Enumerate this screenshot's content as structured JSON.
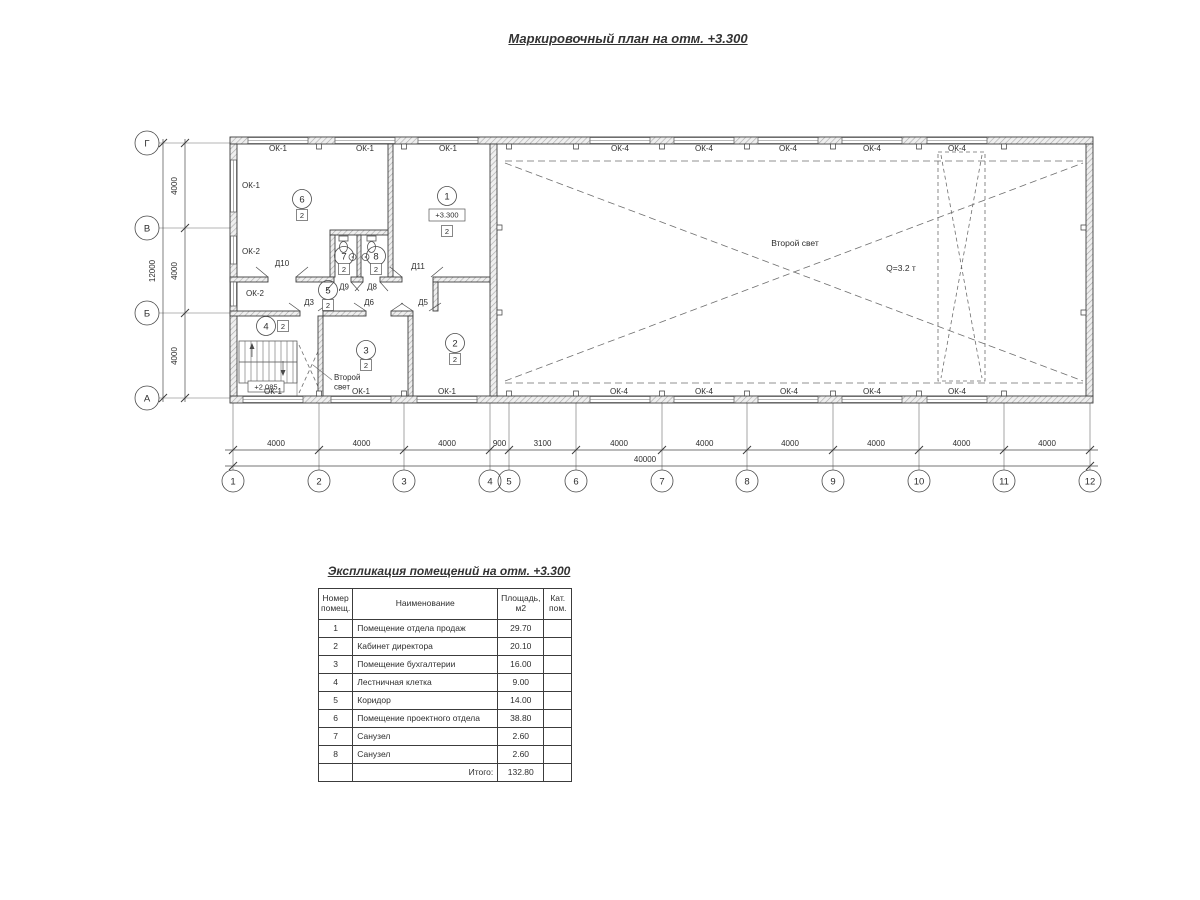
{
  "titles": {
    "plan": "Маркировочный план на отм. +3.300",
    "table": "Экспликация помещений на отм. +3.300"
  },
  "plan": {
    "axis_rows": [
      "Г",
      "В",
      "Б",
      "А"
    ],
    "axis_cols": [
      "1",
      "2",
      "3",
      "4",
      "5",
      "6",
      "7",
      "8",
      "9",
      "10",
      "11",
      "12"
    ],
    "dims_h": [
      "4000",
      "4000",
      "4000",
      "900",
      "3100",
      "4000",
      "4000",
      "4000",
      "4000",
      "4000",
      "4000"
    ],
    "dims_h_total": "40000",
    "dims_v": [
      "4000",
      "4000",
      "4000"
    ],
    "dims_v_total": "12000",
    "windows": {
      "ok1": "ОК-1",
      "ok2": "ОК-2",
      "ok4": "ОК-4"
    },
    "doors": {
      "d3": "Д3",
      "d5": "Д5",
      "d6": "Д6",
      "d8": "Д8",
      "d9": "Д9",
      "d10": "Д10",
      "d11": "Д11"
    },
    "rooms": [
      "1",
      "2",
      "3",
      "4",
      "5",
      "6",
      "7",
      "8"
    ],
    "category": "2",
    "elevation_main": "+3.300",
    "elevation_stairs": "+2.085",
    "second_light": "Второй свет",
    "second_light_l1": "Второй",
    "second_light_l2": "свет",
    "crane": "Q=3.2 т"
  },
  "table": {
    "headers": {
      "num_l1": "Номер",
      "num_l2": "помещ.",
      "name": "Наименование",
      "area_l1": "Площадь,",
      "area_l2": "м2",
      "cat_l1": "Кат.",
      "cat_l2": "пом."
    },
    "rows": [
      {
        "num": "1",
        "name": "Помещение отдела продаж",
        "area": "29.70",
        "cat": ""
      },
      {
        "num": "2",
        "name": "Кабинет директора",
        "area": "20.10",
        "cat": ""
      },
      {
        "num": "3",
        "name": "Помещение бухгалтерии",
        "area": "16.00",
        "cat": ""
      },
      {
        "num": "4",
        "name": "Лестничная клетка",
        "area": "9.00",
        "cat": ""
      },
      {
        "num": "5",
        "name": "Коридор",
        "area": "14.00",
        "cat": ""
      },
      {
        "num": "6",
        "name": "Помещение проектного отдела",
        "area": "38.80",
        "cat": ""
      },
      {
        "num": "7",
        "name": "Санузел",
        "area": "2.60",
        "cat": ""
      },
      {
        "num": "8",
        "name": "Санузел",
        "area": "2.60",
        "cat": ""
      }
    ],
    "total_label": "Итого:",
    "total_value": "132.80"
  }
}
